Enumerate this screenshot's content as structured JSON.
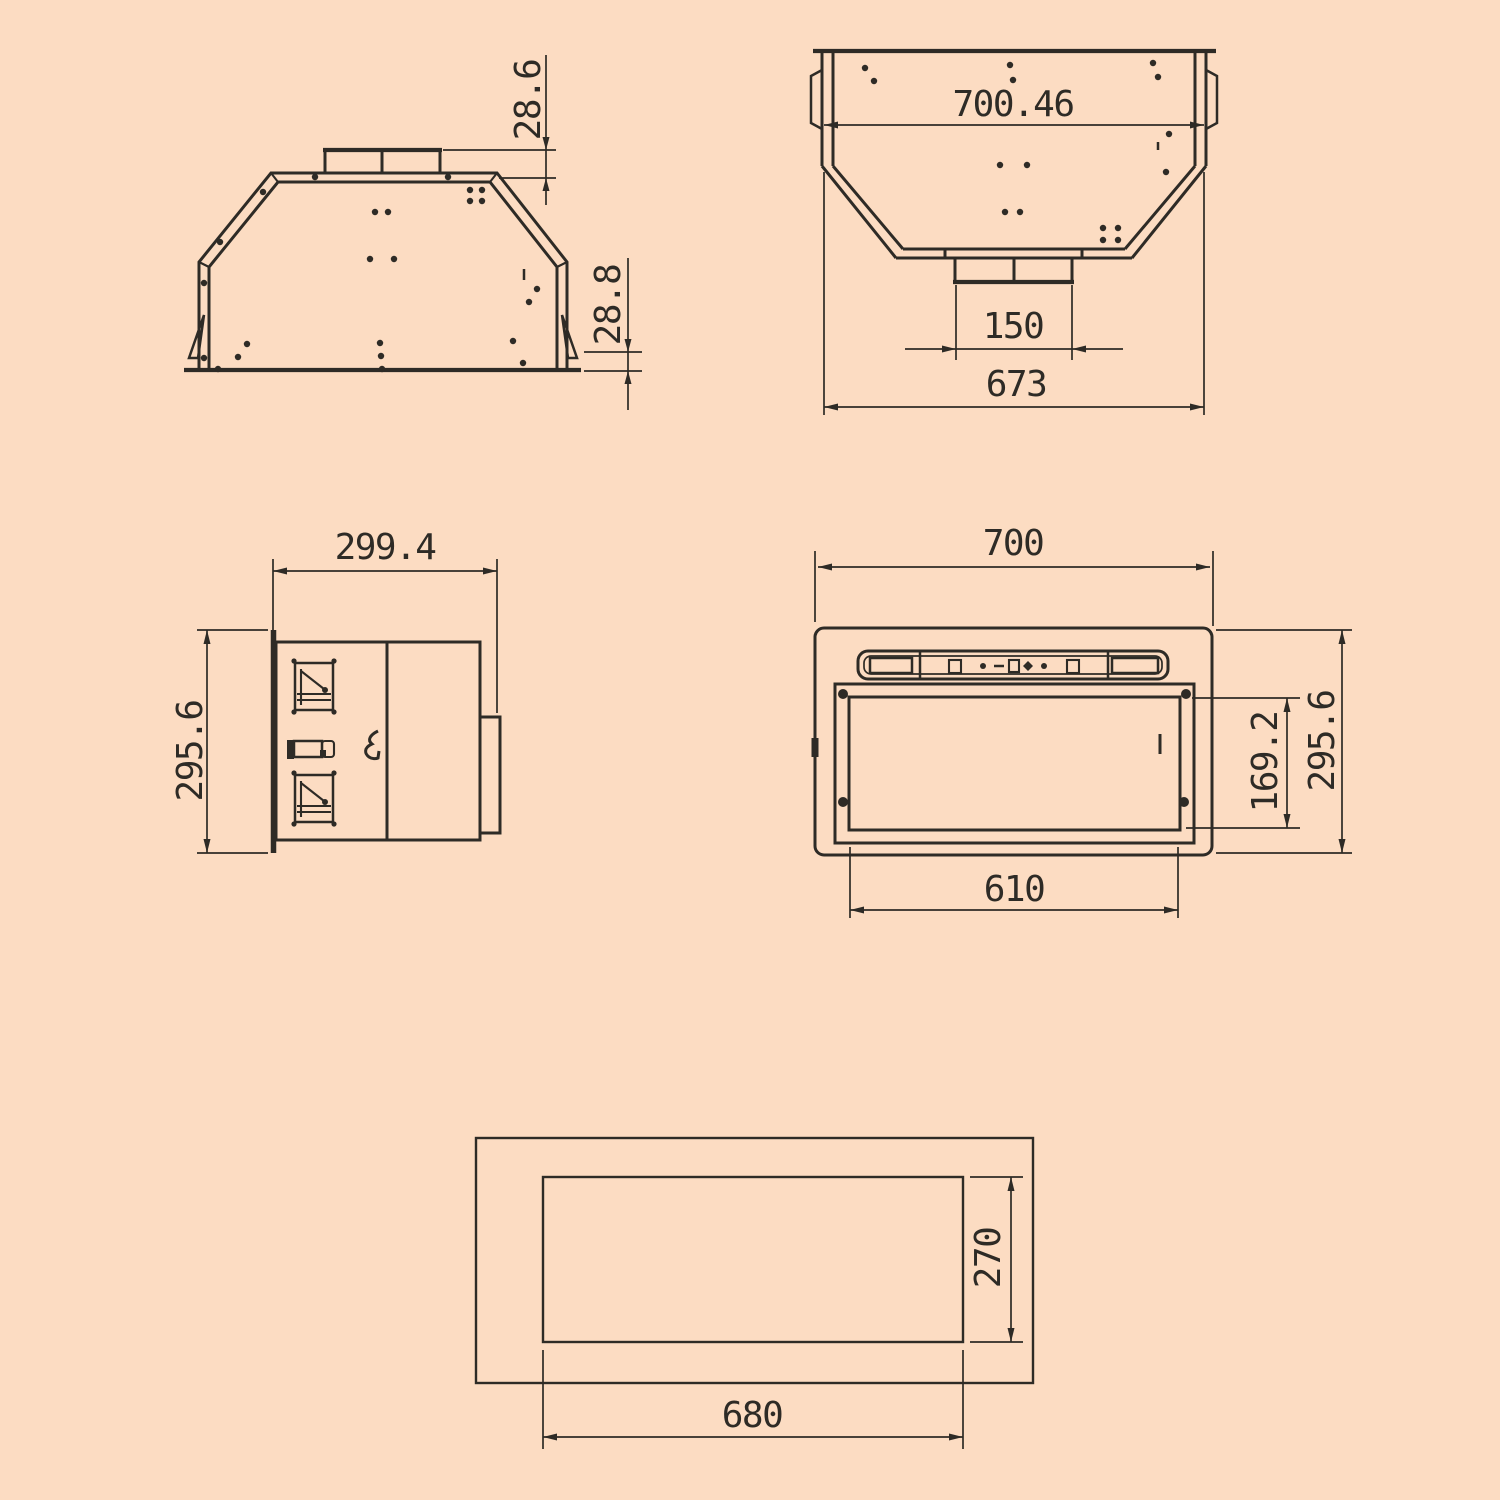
{
  "drawing": {
    "background": "#fcdcc2",
    "line_color": "#2e2b26",
    "views": {
      "front": {
        "duct_height": "28.6",
        "flange_height": "28.8"
      },
      "top": {
        "top_width": "700.46",
        "duct_width": "150",
        "body_width": "673"
      },
      "side": {
        "depth": "299.4",
        "height": "295.6"
      },
      "bottom": {
        "overall_width": "700",
        "filter_opening_height": "169.2",
        "overall_depth": "295.6",
        "filter_opening_width": "610"
      },
      "cutout": {
        "cutout_depth": "270",
        "cutout_width": "680"
      }
    }
  }
}
